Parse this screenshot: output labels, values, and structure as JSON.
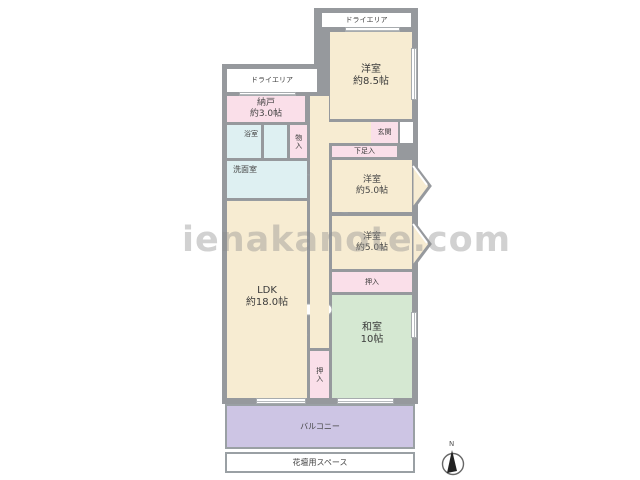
{
  "watermark": "ienakanote.com",
  "compass": {
    "north": "N"
  },
  "palette": {
    "wall": "#96999d",
    "room_cream": "#f7ecd2",
    "room_pink": "#fadfe9",
    "room_aqua": "#def0f2",
    "tatami_green": "#d5e8d2",
    "balcony_purple": "#cdc5e4"
  },
  "rooms": {
    "dry_area_top": {
      "label": "ドライエリア"
    },
    "dry_area_left": {
      "label": "ドライエリア"
    },
    "western_room_85": {
      "label": "洋室",
      "size": "約8.5帖"
    },
    "storage_nando": {
      "label": "納戸",
      "size": "約3.0帖"
    },
    "bathroom": {
      "label": "浴室"
    },
    "closet_monoire": {
      "label": "物入"
    },
    "washroom": {
      "label": "洗面室"
    },
    "entrance_genkan": {
      "label": "玄関"
    },
    "shoe_box": {
      "label": "下足入"
    },
    "western_room_5a": {
      "label": "洋室",
      "size": "約5.0帖"
    },
    "western_room_5b": {
      "label": "洋室",
      "size": "約5.0帖"
    },
    "closet_oshiire_upper": {
      "label": "押入"
    },
    "japanese_room": {
      "label": "和室",
      "size": "10帖"
    },
    "ldk": {
      "label": "LDK",
      "size": "約18.0帖"
    },
    "closet_oshiire_side": {
      "label": "押入"
    },
    "balcony": {
      "label": "バルコニー"
    },
    "flower_bed": {
      "label": "花壇用スペース"
    }
  }
}
